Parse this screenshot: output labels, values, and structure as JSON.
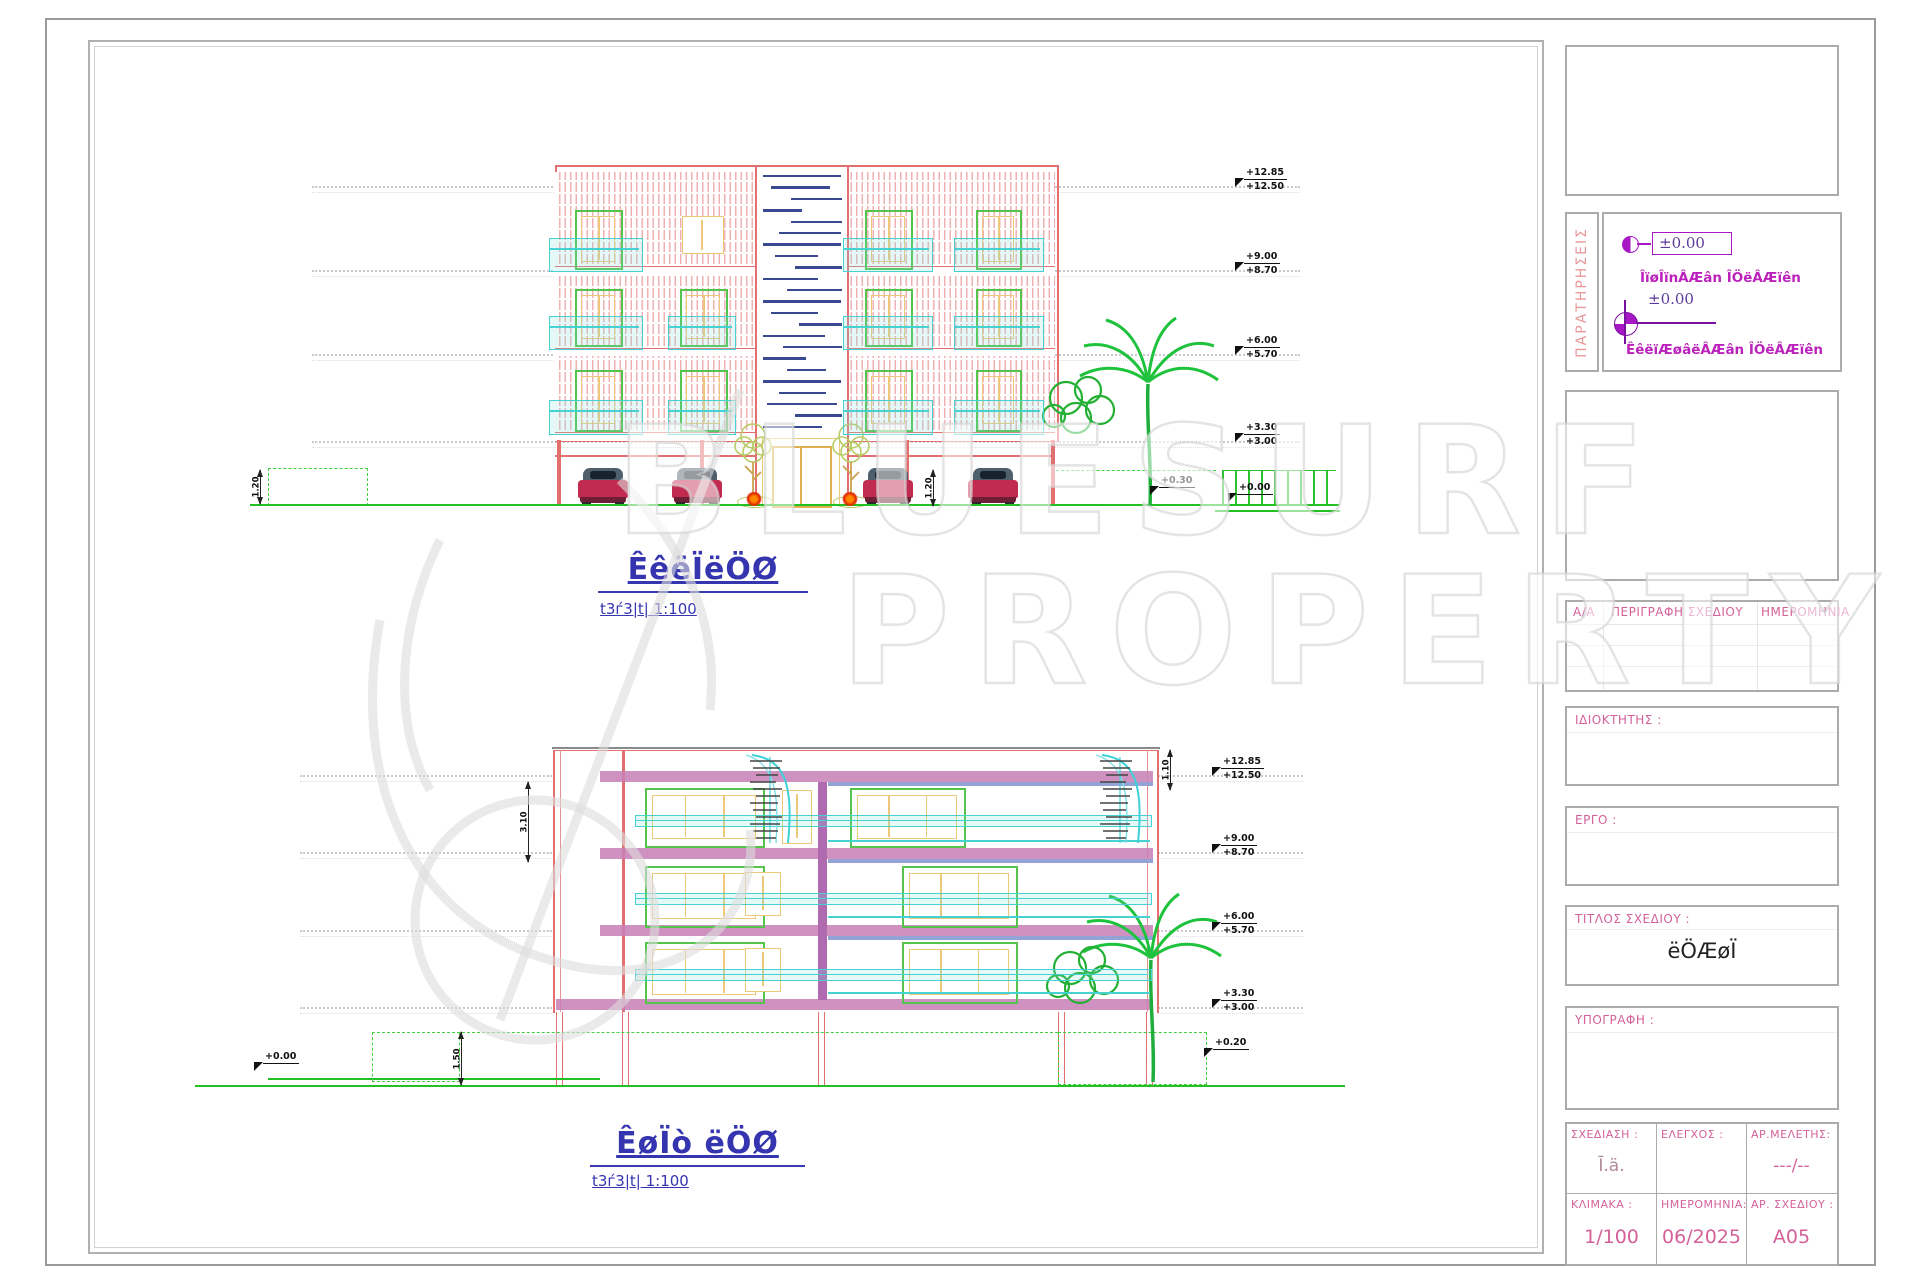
{
  "watermark": {
    "line1": "BLUESURF",
    "line2": "PROPERTY"
  },
  "top_elevation": {
    "label": "ÊêëÏëÖØ",
    "scale_label": "t3ѓ3|t| 1:100",
    "levels": [
      {
        "upper": "+12.85",
        "lower": "+12.50"
      },
      {
        "upper": "+9.00",
        "lower": "+8.70"
      },
      {
        "upper": "+6.00",
        "lower": "+5.70"
      },
      {
        "upper": "+3.30",
        "lower": "+3.00"
      }
    ],
    "ground_left": "+0.30",
    "ground_right": "+0.00",
    "dim_parking": "1.20",
    "dim_left": "1.20"
  },
  "bottom_elevation": {
    "label": "ÊøÏò ëÖØ",
    "scale_label": "t3ѓ3|t| 1:100",
    "levels": [
      {
        "upper": "+12.85",
        "lower": "+12.50"
      },
      {
        "upper": "+9.00",
        "lower": "+8.70"
      },
      {
        "upper": "+6.00",
        "lower": "+5.70"
      },
      {
        "upper": "+3.30",
        "lower": "+3.00"
      }
    ],
    "ground_left": "+0.00",
    "ground_right": "+0.20",
    "dim_roof": "1.10",
    "dim_floor": "3.10",
    "dim_plinth": "1.50"
  },
  "right_panel": {
    "notes": {
      "title": "ΠΑΡΑΤΗΡΗΣΕΙΣ",
      "datum1": "±0.00",
      "note1": "ÎïøÎïnÂÆân ÎÖëÂÆïên",
      "datum2": "±0.00",
      "note2": "ÊêëïÆøâëÂÆân ÎÖëÂÆïên"
    },
    "revision": {
      "col_aa": "Α/Α",
      "col_desc": "ΠΕΡΙΓΡΑΦΗ ΣΧΕΔΙΟΥ",
      "col_date": "ΗΜΕΡΟΜΗΝΙΑ"
    },
    "owner_label": "ΙΔΙΟΚΤΗΤΗΣ :",
    "project_label": "ΕΡΓΟ :",
    "title_label": "ΤΙΤΛΟΣ ΣΧΕΔΙΟΥ :",
    "title_value": "ëÖÆøÏ",
    "signature_label": "ΥΠΟΓΡΑΦΗ :",
    "table": {
      "design_label": "ΣΧΕΔΙΑΣΗ :",
      "design_value": "Ī.ä.",
      "check_label": "ΕΛΕΓΧΟΣ :",
      "check_value": "",
      "study_label": "ΑΡ.ΜΕΛΕΤΗΣ:",
      "study_value": "---/--",
      "scale_label": "ΚΛΙΜΑΚΑ :",
      "scale_value": "1/100",
      "date_label": "ΗΜΕΡΟΜΗΝΙΑ:",
      "date_value": "06/2025",
      "number_label": "ΑΡ. ΣΧΕΔΙΟΥ :",
      "number_value": "A05"
    }
  }
}
